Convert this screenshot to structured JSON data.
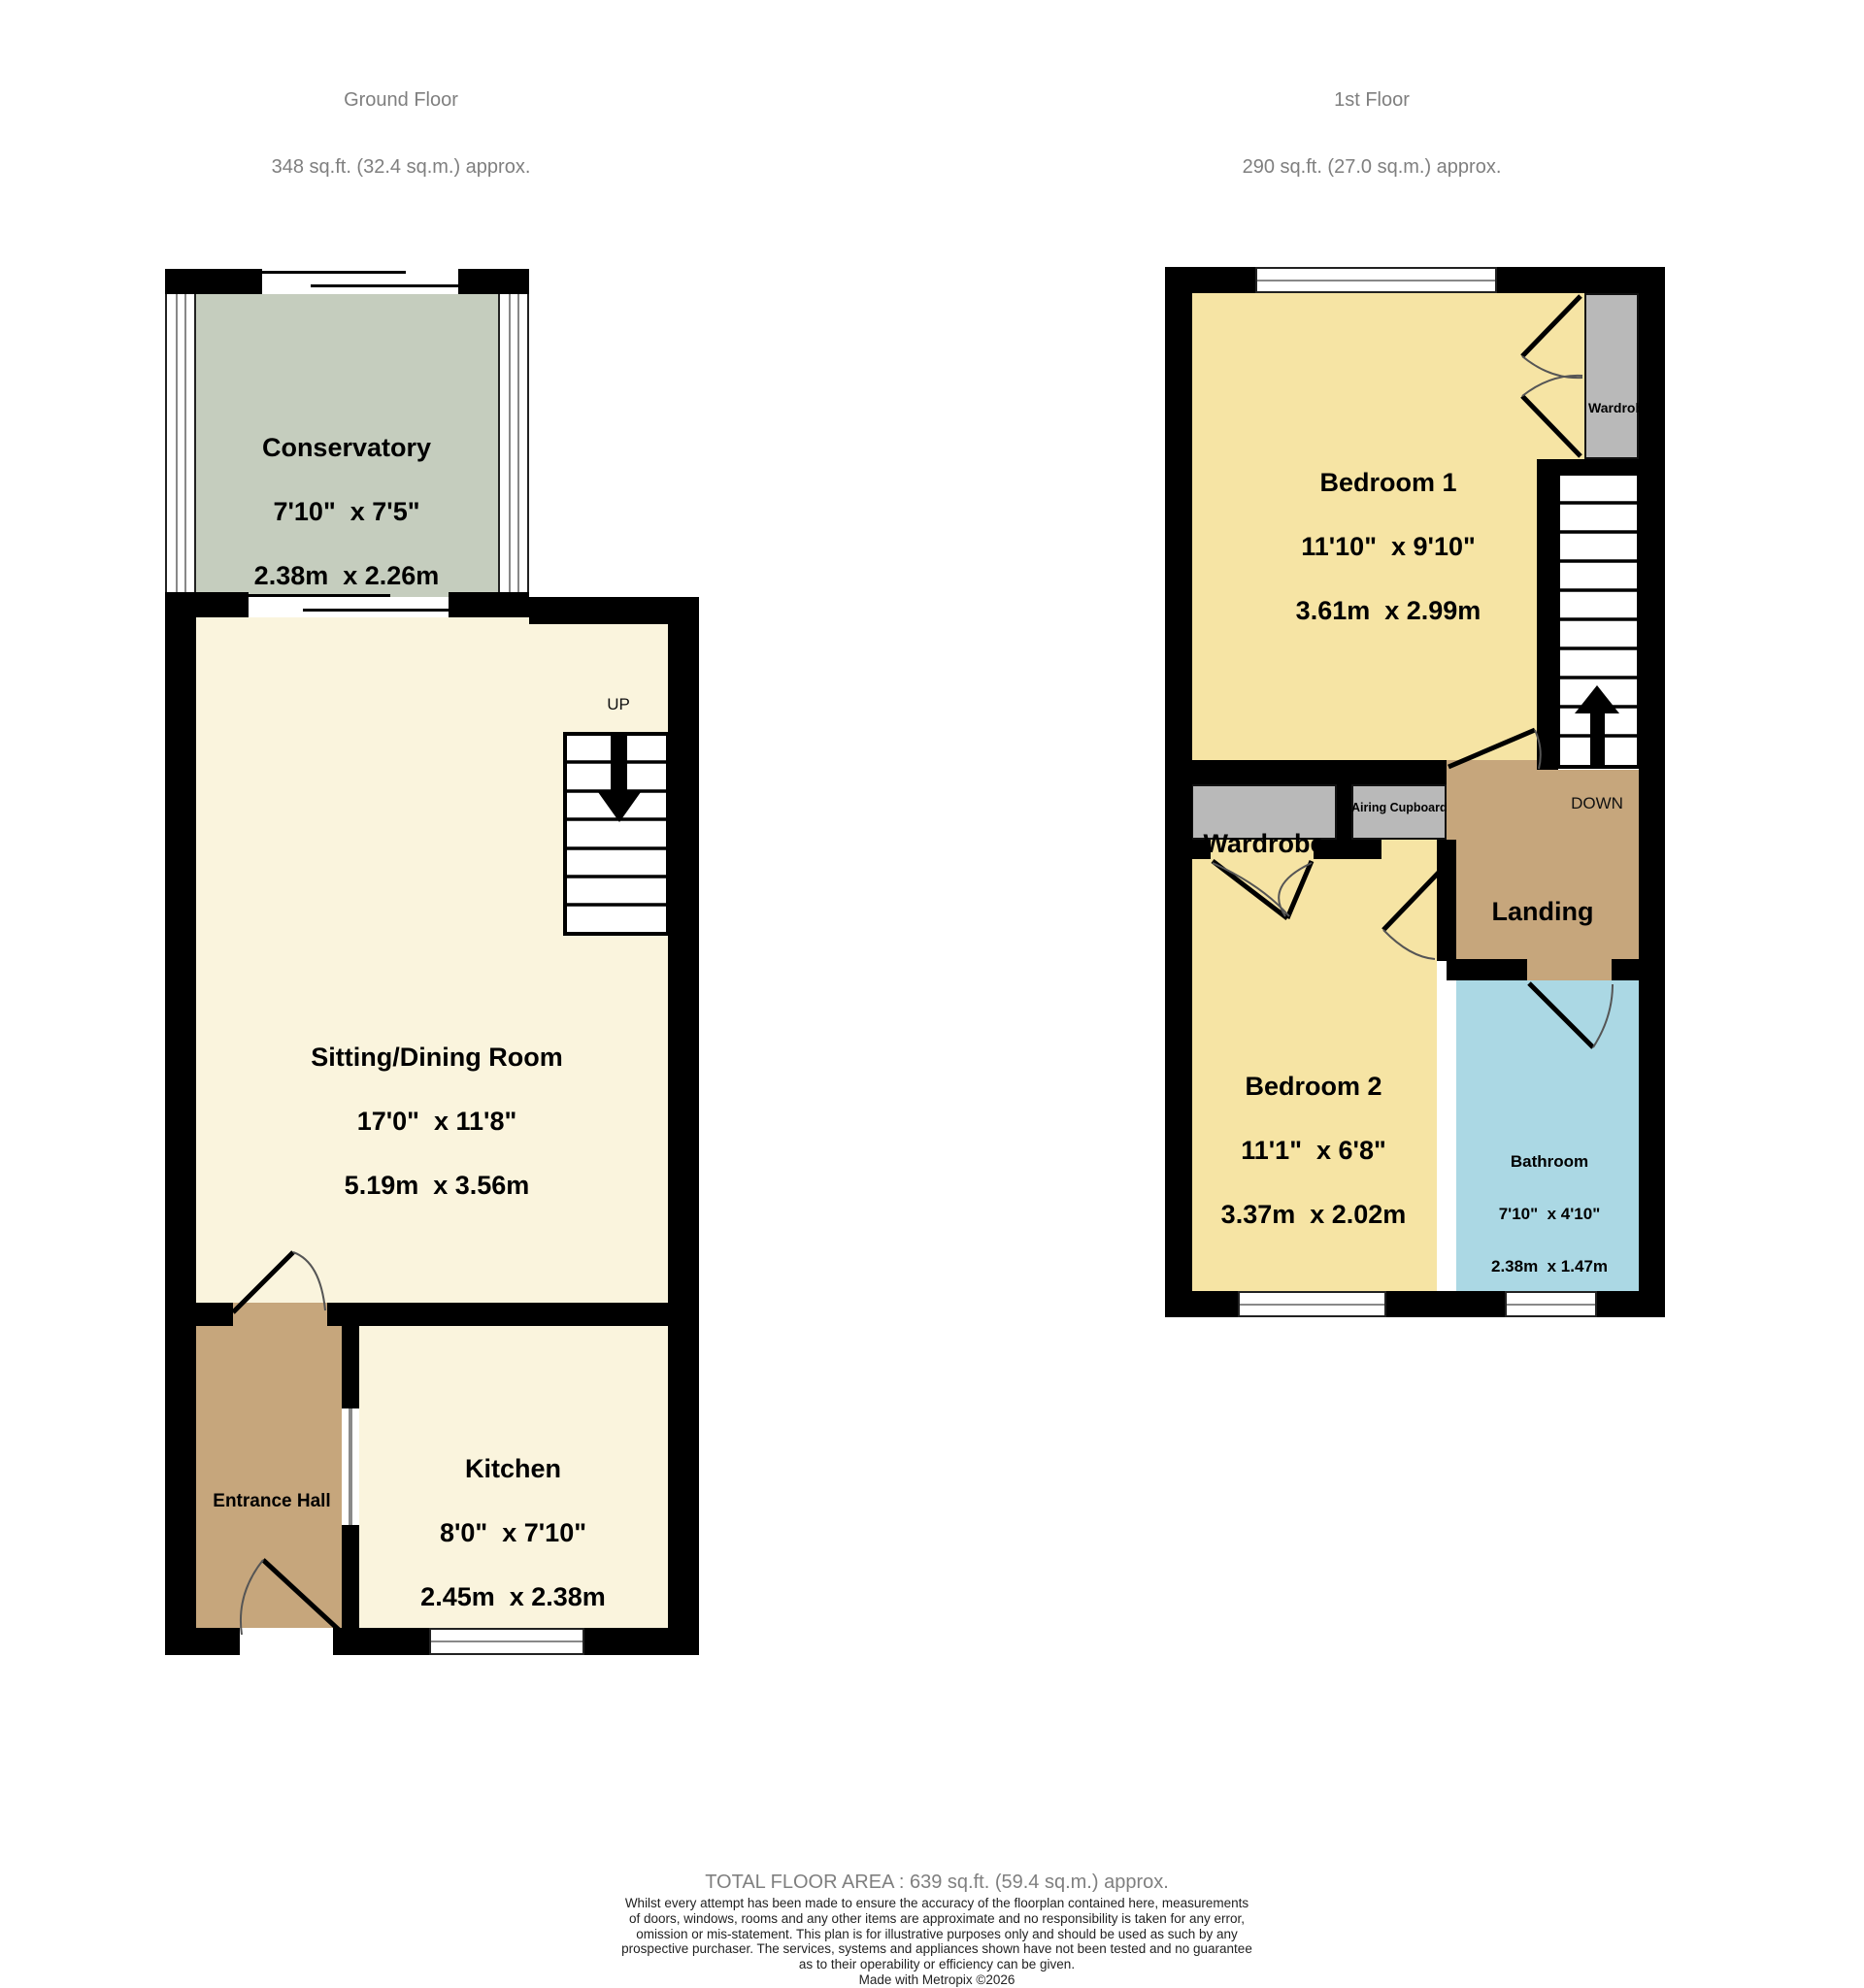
{
  "ground_floor": {
    "title": "Ground Floor",
    "area": "348 sq.ft. (32.4 sq.m.) approx.",
    "stairs_label": "UP",
    "rooms": {
      "conservatory": {
        "name": "Conservatory",
        "imperial": "7'10\"  x 7'5\"",
        "metric": "2.38m  x 2.26m"
      },
      "sitting_dining": {
        "name": "Sitting/Dining Room",
        "imperial": "17'0\"  x 11'8\"",
        "metric": "5.19m  x 3.56m"
      },
      "kitchen": {
        "name": "Kitchen",
        "imperial": "8'0\"  x 7'10\"",
        "metric": "2.45m  x 2.38m"
      },
      "entrance_hall": {
        "name": "Entrance Hall"
      }
    }
  },
  "first_floor": {
    "title": "1st Floor",
    "area": "290 sq.ft. (27.0 sq.m.) approx.",
    "stairs_label": "DOWN",
    "rooms": {
      "bedroom1": {
        "name": "Bedroom 1",
        "imperial": "11'10\"  x 9'10\"",
        "metric": "3.61m  x 2.99m"
      },
      "bedroom2": {
        "name": "Bedroom 2",
        "imperial": "11'1\"  x 6'8\"",
        "metric": "3.37m  x 2.02m"
      },
      "bathroom": {
        "name": "Bathroom",
        "imperial": "7'10\"  x 4'10\"",
        "metric": "2.38m  x 1.47m"
      },
      "landing": {
        "name": "Landing"
      },
      "wardrobe_bedroom1": {
        "name": "Wardrob"
      },
      "wardrobe_bedroom2": {
        "name": "Wardrobe"
      },
      "airing_cupboard": {
        "name": "Airing Cupboard"
      }
    }
  },
  "footer": {
    "total": "TOTAL FLOOR AREA : 639 sq.ft. (59.4 sq.m.) approx.",
    "disclaimer_lines": [
      "Whilst every attempt has been made to ensure the accuracy of the floorplan contained here, measurements",
      "of doors, windows, rooms and any other items are approximate and no responsibility is taken for any error,",
      "omission or mis-statement. This plan is for illustrative purposes only and should be used as such by any",
      "prospective purchaser. The services, systems and appliances shown have not been tested and no guarantee",
      "as to their operability or efficiency can be given."
    ],
    "credit": "Made with Metropix ©2026"
  },
  "colors": {
    "wall": "#000000",
    "room_cream": "#faf4dd",
    "conservatory_green": "#c5cdbe",
    "bedroom_yellow": "#f6e4a4",
    "hall_landing_tan": "#c6a67c",
    "bathroom_blue": "#abd8e4",
    "wardrobe_gray": "#b9b9b9",
    "title_gray": "#7f7f7f"
  }
}
